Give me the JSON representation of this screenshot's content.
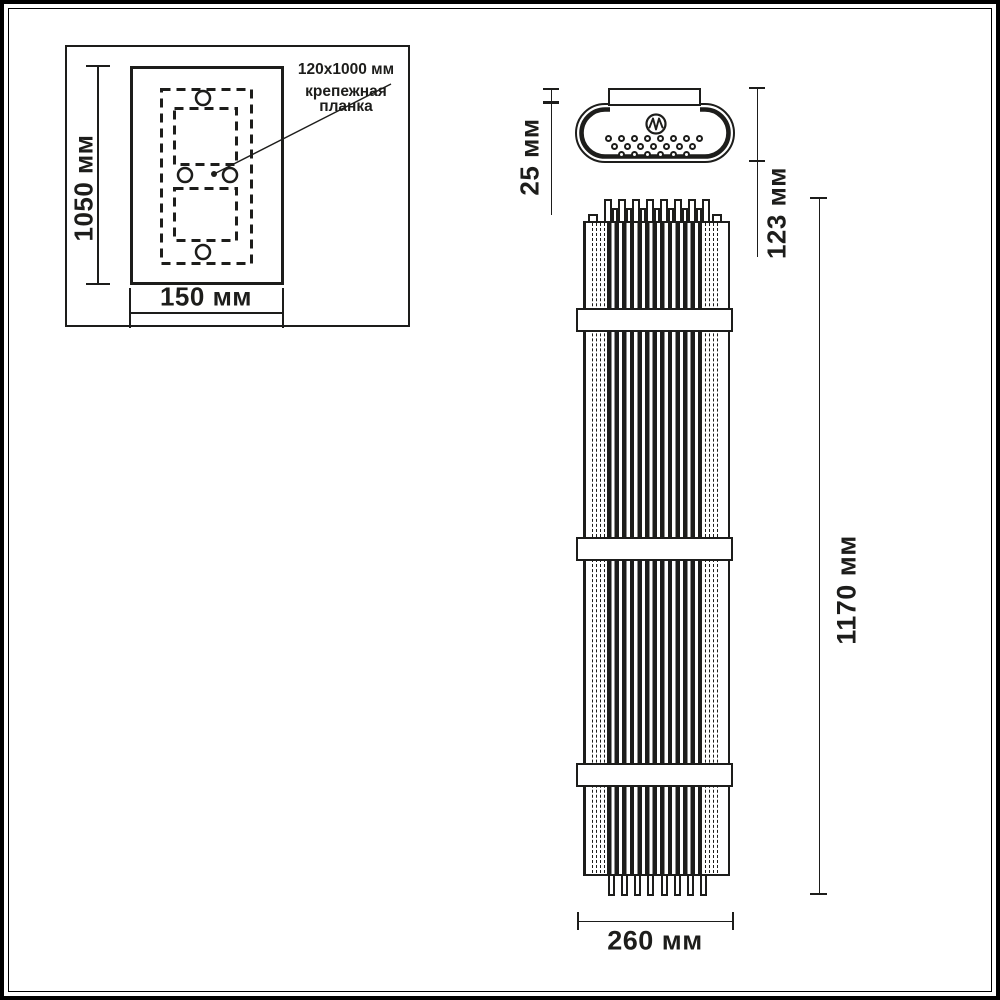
{
  "colors": {
    "line": "#1d1d1b",
    "background": "#ffffff"
  },
  "inset": {
    "height_dim": "1050 мм",
    "width_dim": "150 мм",
    "annotation": {
      "line1": "120x1000 мм",
      "line2": "крепежная",
      "line3": "планка"
    }
  },
  "top_view": {
    "plate_depth_dim": "25 мм",
    "overall_depth_dim": "123 мм"
  },
  "front_view": {
    "overall_height_dim": "1170 мм",
    "overall_width_dim": "260 мм"
  }
}
